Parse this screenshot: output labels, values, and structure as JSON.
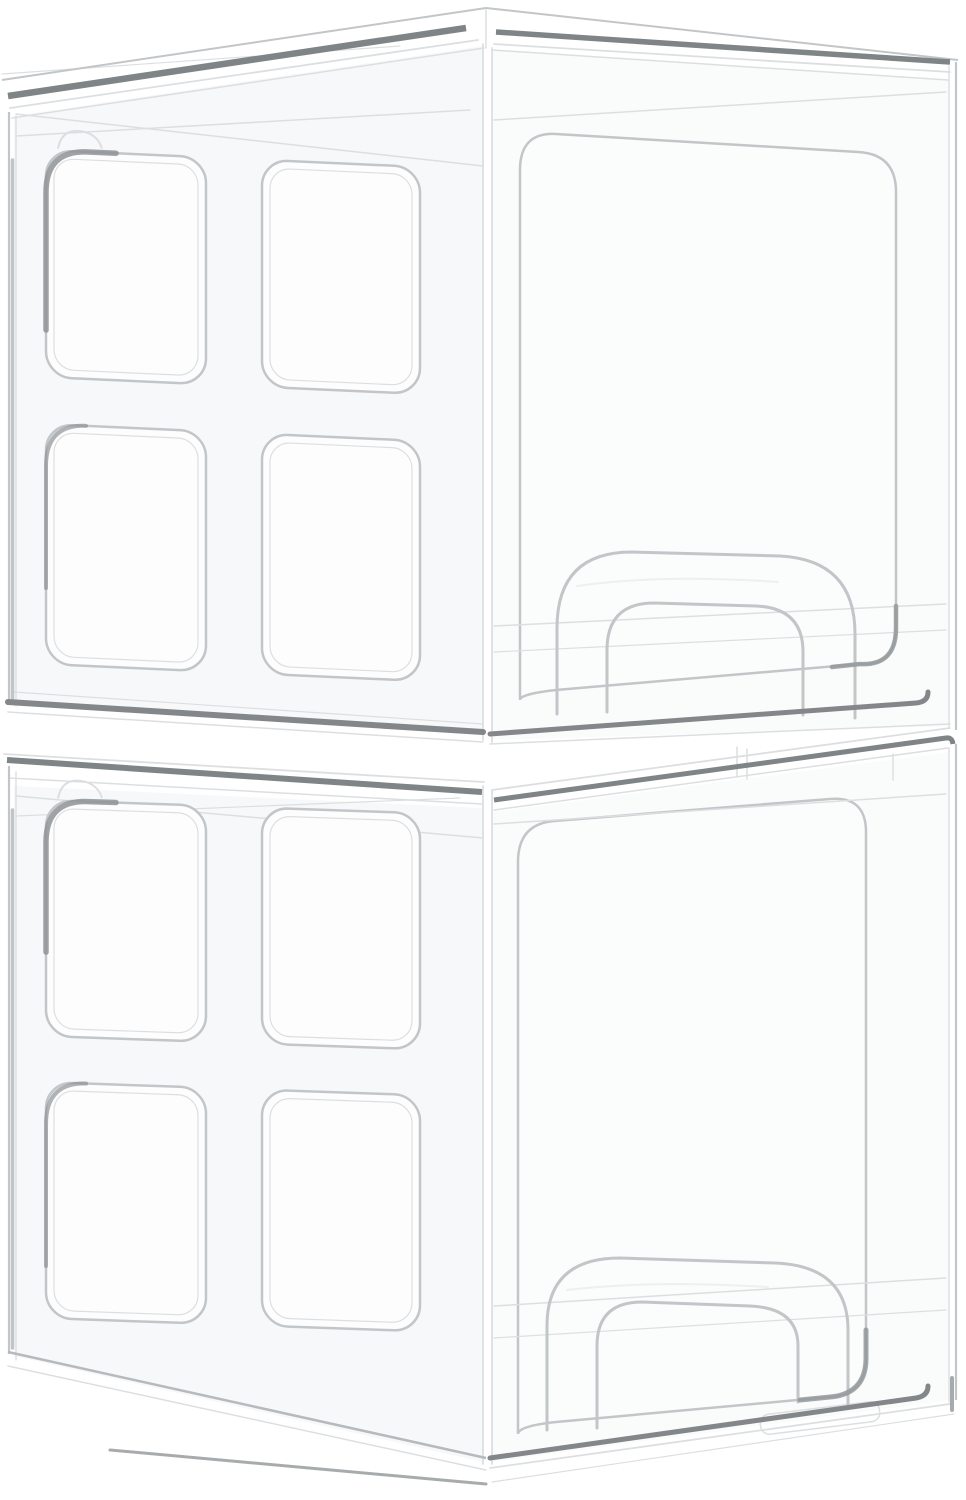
{
  "image": {
    "kind": "product-photo",
    "subject": "Two stacked clear plastic stackable storage drawer organizers",
    "background": "#ffffff"
  },
  "colors": {
    "background": "#ffffff",
    "edge_light": "#dcdfe1",
    "edge_mid": "#c2c6c9",
    "edge_strong": "#b6babd",
    "stripe_dark": "#7f8487",
    "band_dark": "#83878a",
    "shadow_dark": "#8f9396",
    "highlight": "#edeff0",
    "left_face_tint": "#f7f8f9",
    "front_face_tint": "#fafbfb",
    "panel_fill": "#fdfdfe",
    "inset_fill": "#fbfcfc"
  },
  "units": [
    {
      "id": "top-unit",
      "label": "Top stackable drawer unit",
      "features": {
        "side_panels": 4,
        "drawer": "front pull-out drawer",
        "drawer_handle": "arched clear pull handle",
        "lid": "flat stacking lid"
      }
    },
    {
      "id": "bottom-unit",
      "label": "Bottom stackable drawer unit",
      "features": {
        "side_panels": 4,
        "drawer": "front pull-out drawer",
        "drawer_handle": "arched clear pull handle",
        "lid": "flat stacking lid"
      }
    }
  ]
}
